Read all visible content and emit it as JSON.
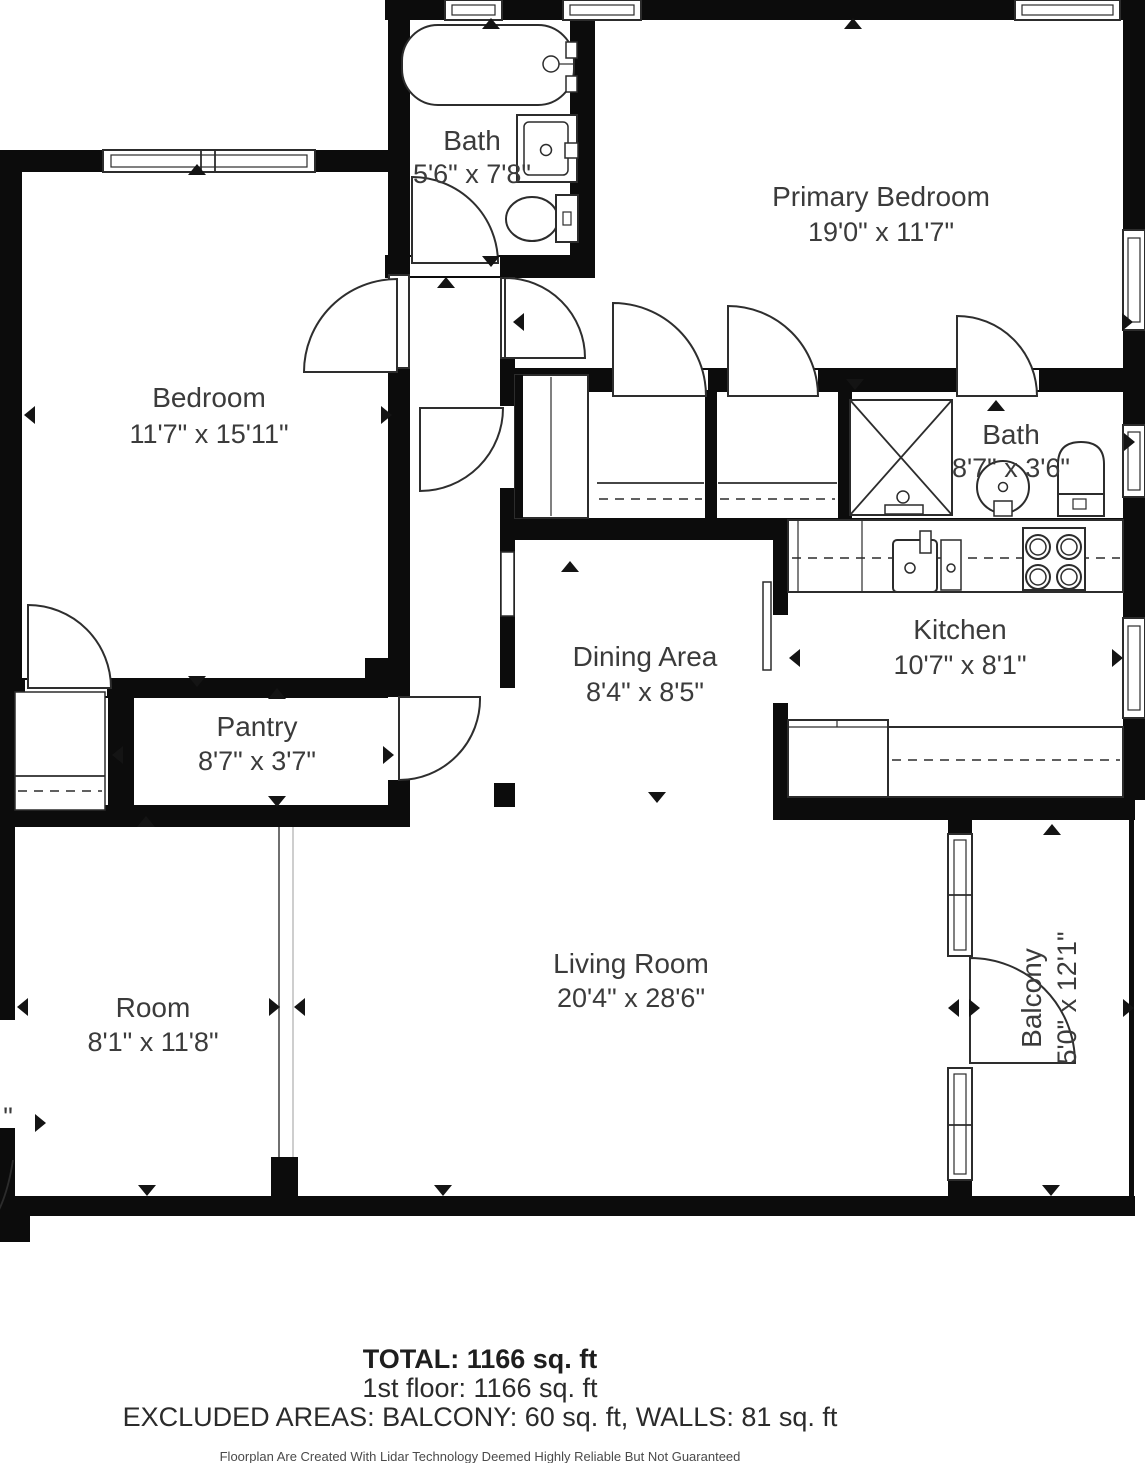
{
  "rooms": {
    "bath1": {
      "name": "Bath",
      "dims": "5'6\" x 7'8\""
    },
    "primary": {
      "name": "Primary Bedroom",
      "dims": "19'0\" x 11'7\""
    },
    "bedroom": {
      "name": "Bedroom",
      "dims": "11'7\" x 15'11\""
    },
    "bath2": {
      "name": "Bath",
      "dims": "8'7\" x 3'6\""
    },
    "kitchen": {
      "name": "Kitchen",
      "dims": "10'7\" x 8'1\""
    },
    "dining": {
      "name": "Dining Area",
      "dims": "8'4\" x 8'5\""
    },
    "pantry": {
      "name": "Pantry",
      "dims": "8'7\" x 3'7\""
    },
    "living": {
      "name": "Living Room",
      "dims": "20'4\" x 28'6\""
    },
    "room": {
      "name": "Room",
      "dims": "8'1\" x 11'8\""
    },
    "balcony": {
      "name": "Balcony",
      "dims": "5'0\" x 12'1\""
    }
  },
  "summary": {
    "total": "TOTAL: 1166 sq. ft",
    "floor1": "1st floor: 1166 sq. ft",
    "excluded": "EXCLUDED AREAS: BALCONY: 60 sq. ft, WALLS: 81 sq. ft"
  },
  "disclaimer": "Floorplan Are Created With Lidar Technology Deemed Highly Reliable But Not Guaranteed",
  "fragments": {
    "left_edge_dim": "\""
  },
  "colors": {
    "wall": "#0c0c0c",
    "text": "#3b3b3b",
    "background": "#ffffff"
  }
}
